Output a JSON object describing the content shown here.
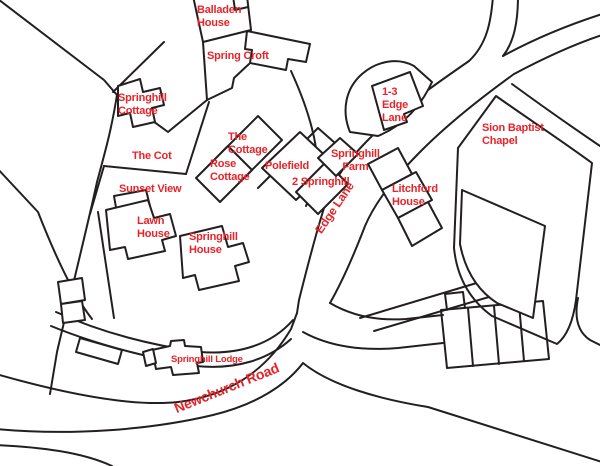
{
  "map": {
    "colors": {
      "label": "#e8232a",
      "line": "#231f20",
      "background": "#ffffff"
    },
    "labels": [
      {
        "id": "balladen-house",
        "text": "Balladen\nHouse"
      },
      {
        "id": "spring-croft",
        "text": "Spring Croft"
      },
      {
        "id": "springhill-cottage",
        "text": "Springhill\nCottage"
      },
      {
        "id": "edge-lane-1-3",
        "text": "1-3\nEdge\nLane"
      },
      {
        "id": "sion-baptist-chapel",
        "text": "Sion Baptist\nChapel"
      },
      {
        "id": "the-cottage",
        "text": "The\nCottage"
      },
      {
        "id": "the-cot",
        "text": "The Cot"
      },
      {
        "id": "rose-cottage",
        "text": "Rose\nCottage"
      },
      {
        "id": "polefield",
        "text": "Polefield"
      },
      {
        "id": "springhill-farm",
        "text": "Springhill\nFarm"
      },
      {
        "id": "two-springhill",
        "text": "2 Springhill"
      },
      {
        "id": "sunset-view",
        "text": "Sunset View"
      },
      {
        "id": "lawn-house",
        "text": "Lawn\nHouse"
      },
      {
        "id": "springhill-house",
        "text": "Springhill\nHouse"
      },
      {
        "id": "litchford-house",
        "text": "Litchford\nHouse"
      },
      {
        "id": "edge-lane-road",
        "text": "Edge Lane"
      },
      {
        "id": "springhill-lodge",
        "text": "Springhill Lodge"
      },
      {
        "id": "newchurch-road",
        "text": "Newchurch Road"
      }
    ]
  }
}
